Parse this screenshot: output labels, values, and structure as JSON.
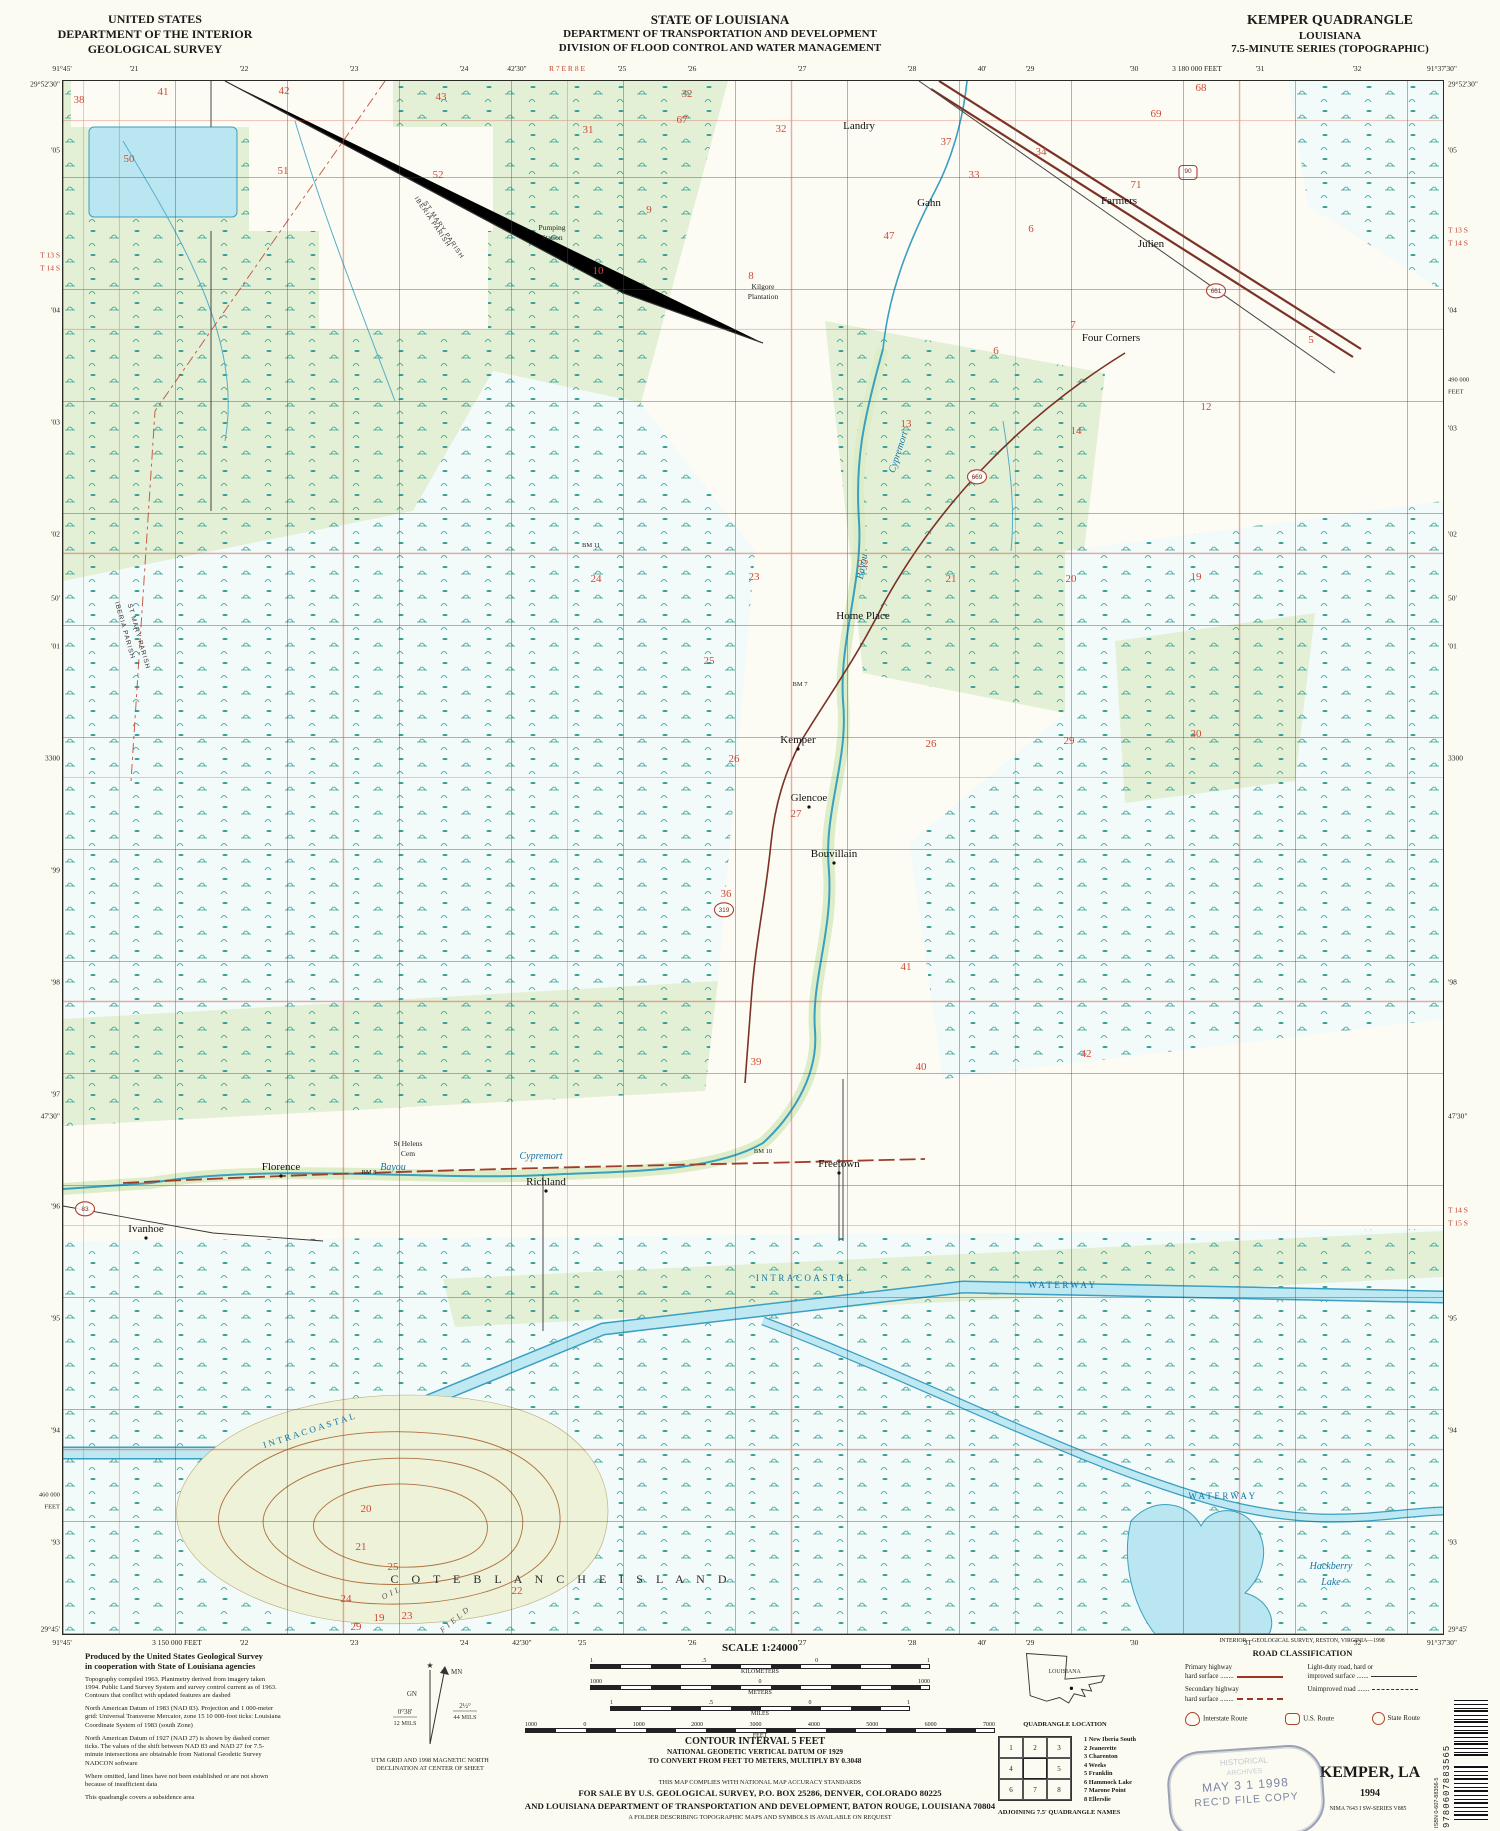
{
  "header": {
    "left": [
      "UNITED STATES",
      "DEPARTMENT OF THE INTERIOR",
      "GEOLOGICAL SURVEY"
    ],
    "center": [
      "STATE OF LOUISIANA",
      "DEPARTMENT OF TRANSPORTATION AND DEVELOPMENT",
      "DIVISION OF FLOOD CONTROL AND WATER MANAGEMENT"
    ],
    "right": [
      "KEMPER QUADRANGLE",
      "LOUISIANA",
      "7.5-MINUTE SERIES (TOPOGRAPHIC)"
    ]
  },
  "map": {
    "colors": {
      "marsh_teal": "#2e9e96",
      "wood_green": "#e3f0d5",
      "marsh_white": "#f3fafa",
      "water_fill": "#b9e6f0",
      "water_line": "#3b9fc1",
      "survey_red": "#c0432f",
      "road_brown": "#7a3226",
      "contour_brown": "#b0713f",
      "section_red": "#cf4a36"
    },
    "labels": [
      {
        "x": 796,
        "y": 48,
        "t": "Landry"
      },
      {
        "x": 489,
        "y": 149,
        "t": "Pumping",
        "c": "sm"
      },
      {
        "x": 489,
        "y": 159,
        "t": "Station",
        "c": "sm"
      },
      {
        "x": 700,
        "y": 208,
        "t": "Kilgore",
        "c": "sm"
      },
      {
        "x": 700,
        "y": 218,
        "t": "Plantation",
        "c": "sm"
      },
      {
        "x": 866,
        "y": 125,
        "t": "Gahn"
      },
      {
        "x": 1056,
        "y": 123,
        "t": "Farmers"
      },
      {
        "x": 1088,
        "y": 166,
        "t": "Julien"
      },
      {
        "x": 1048,
        "y": 260,
        "t": "Four Corners"
      },
      {
        "x": 800,
        "y": 538,
        "t": "Home Place"
      },
      {
        "x": 735,
        "y": 662,
        "t": "Kemper",
        "d": 1
      },
      {
        "x": 746,
        "y": 720,
        "t": "Glencoe",
        "d": 1
      },
      {
        "x": 771,
        "y": 776,
        "t": "Bouvillain",
        "d": 1
      },
      {
        "x": 218,
        "y": 1089,
        "t": "Florence",
        "d": 1
      },
      {
        "x": 483,
        "y": 1104,
        "t": "Richland",
        "d": 1
      },
      {
        "x": 776,
        "y": 1086,
        "t": "Freetown",
        "d": 1
      },
      {
        "x": 83,
        "y": 1151,
        "t": "Ivanhoe",
        "d": 1
      },
      {
        "x": 345,
        "y": 1065,
        "t": "St Helens",
        "c": "sm"
      },
      {
        "x": 345,
        "y": 1075,
        "t": "Cem",
        "c": "sm"
      },
      {
        "x": 498,
        "y": 1502,
        "t": "C O T E   B L A N C H E   I S L A N D",
        "c": "isl"
      },
      {
        "x": 330,
        "y": 1514,
        "t": "OIL",
        "c": "fld",
        "r": -25
      },
      {
        "x": 394,
        "y": 1540,
        "t": "FIELD",
        "c": "fld",
        "r": -40
      },
      {
        "x": 1268,
        "y": 1488,
        "t": "Hackberry",
        "c": "wat"
      },
      {
        "x": 1268,
        "y": 1504,
        "t": "Lake",
        "c": "wat"
      },
      {
        "x": 330,
        "y": 1089,
        "t": "Bayou",
        "c": "wat"
      },
      {
        "x": 478,
        "y": 1078,
        "t": "Cypremort",
        "c": "wat"
      },
      {
        "x": 838,
        "y": 372,
        "t": "Cypremort",
        "c": "wat",
        "r": -72
      },
      {
        "x": 802,
        "y": 486,
        "t": "Bayou",
        "c": "wat",
        "r": -80
      },
      {
        "x": 248,
        "y": 1352,
        "t": "INTRACOASTAL",
        "c": "wt2",
        "r": -18
      },
      {
        "x": 742,
        "y": 1200,
        "t": "INTRACOASTAL",
        "c": "wt2"
      },
      {
        "x": 1000,
        "y": 1207,
        "t": "WATERWAY",
        "c": "wt2"
      },
      {
        "x": 1160,
        "y": 1418,
        "t": "WATERWAY",
        "c": "wt2"
      },
      {
        "x": 368,
        "y": 142,
        "t": "IBERIA PARISH",
        "c": "par",
        "r": 56
      },
      {
        "x": 379,
        "y": 150,
        "t": "ST MARY PARISH",
        "c": "par",
        "r": 56
      },
      {
        "x": 60,
        "y": 550,
        "t": "IBERIA PARISH",
        "c": "par",
        "r": 74
      },
      {
        "x": 74,
        "y": 556,
        "t": "ST MARY PARISH",
        "c": "par",
        "r": 74
      },
      {
        "x": 306,
        "y": 1093,
        "t": "BM 8",
        "c": "bm"
      },
      {
        "x": 528,
        "y": 466,
        "t": "BM 11",
        "c": "bm"
      },
      {
        "x": 737,
        "y": 605,
        "t": "BM 7",
        "c": "bm"
      },
      {
        "x": 700,
        "y": 1072,
        "t": "BM 10",
        "c": "bm"
      }
    ],
    "sections": [
      [
        16,
        22,
        "38"
      ],
      [
        100,
        14,
        "41"
      ],
      [
        221,
        13,
        "42"
      ],
      [
        378,
        19,
        "43"
      ],
      [
        525,
        52,
        "31"
      ],
      [
        624,
        16,
        "32"
      ],
      [
        619,
        42,
        "67"
      ],
      [
        718,
        51,
        "32"
      ],
      [
        883,
        64,
        "37"
      ],
      [
        911,
        97,
        "33"
      ],
      [
        978,
        74,
        "34"
      ],
      [
        1093,
        36,
        "69"
      ],
      [
        1138,
        10,
        "68"
      ],
      [
        1073,
        107,
        "71"
      ],
      [
        66,
        81,
        "50"
      ],
      [
        220,
        93,
        "51"
      ],
      [
        375,
        97,
        "52"
      ],
      [
        586,
        132,
        "9"
      ],
      [
        826,
        158,
        "47"
      ],
      [
        968,
        151,
        "6"
      ],
      [
        535,
        193,
        "10"
      ],
      [
        688,
        198,
        "8"
      ],
      [
        933,
        273,
        "6"
      ],
      [
        1013,
        353,
        "14"
      ],
      [
        843,
        346,
        "13"
      ],
      [
        1143,
        329,
        "12"
      ],
      [
        533,
        501,
        "24"
      ],
      [
        691,
        499,
        "23"
      ],
      [
        800,
        486,
        "22"
      ],
      [
        888,
        501,
        "21"
      ],
      [
        1008,
        501,
        "20"
      ],
      [
        1133,
        499,
        "19"
      ],
      [
        646,
        583,
        "25"
      ],
      [
        671,
        681,
        "26"
      ],
      [
        868,
        666,
        "26"
      ],
      [
        1006,
        663,
        "29"
      ],
      [
        1133,
        656,
        "30"
      ],
      [
        733,
        736,
        "27"
      ],
      [
        663,
        816,
        "36"
      ],
      [
        843,
        889,
        "41"
      ],
      [
        1023,
        976,
        "42"
      ],
      [
        693,
        984,
        "39"
      ],
      [
        858,
        989,
        "40"
      ],
      [
        1010,
        247,
        "7"
      ],
      [
        1248,
        262,
        "5"
      ],
      [
        303,
        1431,
        "20"
      ],
      [
        298,
        1469,
        "21"
      ],
      [
        330,
        1489,
        "25"
      ],
      [
        283,
        1521,
        "24"
      ],
      [
        316,
        1540,
        "19"
      ],
      [
        344,
        1538,
        "23"
      ],
      [
        454,
        1513,
        "22"
      ],
      [
        293,
        1549,
        "29"
      ]
    ],
    "shields": [
      {
        "x": 1125,
        "y": 92,
        "n": "90",
        "k": "us"
      },
      {
        "x": 1153,
        "y": 212,
        "n": "661",
        "k": "st"
      },
      {
        "x": 914,
        "y": 398,
        "n": "669",
        "k": "st"
      },
      {
        "x": 22,
        "y": 1130,
        "n": "83",
        "k": "st"
      },
      {
        "x": 661,
        "y": 831,
        "n": "319",
        "k": "st"
      }
    ],
    "ticks": {
      "top": [
        {
          "x": 0,
          "t": "91°45'"
        },
        {
          "x": 72,
          "t": "'21"
        },
        {
          "x": 182,
          "t": "'22"
        },
        {
          "x": 292,
          "t": "'23"
        },
        {
          "x": 402,
          "t": "'24"
        },
        {
          "x": 455,
          "t": "42'30\""
        },
        {
          "x": 505,
          "t": "R 7 E  R 8 E",
          "c": "red"
        },
        {
          "x": 560,
          "t": "'25"
        },
        {
          "x": 630,
          "t": "'26"
        },
        {
          "x": 740,
          "t": "'27"
        },
        {
          "x": 850,
          "t": "'28"
        },
        {
          "x": 920,
          "t": "40'"
        },
        {
          "x": 968,
          "t": "'29"
        },
        {
          "x": 1072,
          "t": "'30"
        },
        {
          "x": 1135,
          "t": "3 180 000 FEET"
        },
        {
          "x": 1198,
          "t": "'31"
        },
        {
          "x": 1295,
          "t": "'32"
        },
        {
          "x": 1380,
          "t": "91°37'30\""
        }
      ],
      "bottom": [
        {
          "x": 0,
          "t": "91°45'"
        },
        {
          "x": 115,
          "t": "3 150 000 FEET"
        },
        {
          "x": 182,
          "t": "'22"
        },
        {
          "x": 292,
          "t": "'23"
        },
        {
          "x": 402,
          "t": "'24"
        },
        {
          "x": 460,
          "t": "42'30\""
        },
        {
          "x": 520,
          "t": "'25"
        },
        {
          "x": 630,
          "t": "'26"
        },
        {
          "x": 740,
          "t": "'27"
        },
        {
          "x": 850,
          "t": "'28"
        },
        {
          "x": 920,
          "t": "40'"
        },
        {
          "x": 968,
          "t": "'29"
        },
        {
          "x": 1072,
          "t": "'30"
        },
        {
          "x": 1185,
          "t": "'31"
        },
        {
          "x": 1295,
          "t": "'32"
        },
        {
          "x": 1380,
          "t": "91°37'30\""
        }
      ],
      "left": [
        {
          "y": 4,
          "t": "29°52'30\""
        },
        {
          "y": 70,
          "t": "'05"
        },
        {
          "y": 175,
          "t": "T 13 S",
          "c": "red"
        },
        {
          "y": 188,
          "t": "T 14 S",
          "c": "red"
        },
        {
          "y": 230,
          "t": "'04"
        },
        {
          "y": 342,
          "t": "'03"
        },
        {
          "y": 454,
          "t": "'02"
        },
        {
          "y": 518,
          "t": "50'"
        },
        {
          "y": 566,
          "t": "'01"
        },
        {
          "y": 678,
          "t": "3300"
        },
        {
          "y": 790,
          "t": "'99"
        },
        {
          "y": 902,
          "t": "'98"
        },
        {
          "y": 1014,
          "t": "'97"
        },
        {
          "y": 1036,
          "t": "47'30\""
        },
        {
          "y": 1126,
          "t": "'96"
        },
        {
          "y": 1238,
          "t": "'95"
        },
        {
          "y": 1350,
          "t": "'94"
        },
        {
          "y": 1415,
          "t": "460 000",
          "c": "ft"
        },
        {
          "y": 1427,
          "t": "FEET",
          "c": "ft"
        },
        {
          "y": 1462,
          "t": "'93"
        },
        {
          "y": 1549,
          "t": "29°45'"
        }
      ],
      "right": [
        {
          "y": 4,
          "t": "29°52'30\""
        },
        {
          "y": 70,
          "t": "'05"
        },
        {
          "y": 150,
          "t": "T 13 S",
          "c": "red"
        },
        {
          "y": 163,
          "t": "T 14 S",
          "c": "red"
        },
        {
          "y": 230,
          "t": "'04"
        },
        {
          "y": 300,
          "t": "490 000",
          "c": "ft"
        },
        {
          "y": 312,
          "t": "FEET",
          "c": "ft"
        },
        {
          "y": 348,
          "t": "'03"
        },
        {
          "y": 454,
          "t": "'02"
        },
        {
          "y": 518,
          "t": "50'"
        },
        {
          "y": 566,
          "t": "'01"
        },
        {
          "y": 678,
          "t": "3300"
        },
        {
          "y": 902,
          "t": "'98"
        },
        {
          "y": 1036,
          "t": "47'30\""
        },
        {
          "y": 1130,
          "t": "T 14 S",
          "c": "red"
        },
        {
          "y": 1143,
          "t": "T 15 S",
          "c": "red"
        },
        {
          "y": 1238,
          "t": "'95"
        },
        {
          "y": 1350,
          "t": "'94"
        },
        {
          "y": 1462,
          "t": "'93"
        },
        {
          "y": 1549,
          "t": "29°45'"
        }
      ]
    }
  },
  "footer": {
    "credit": "INTERIOR—GEOLOGICAL SURVEY, RESTON, VIRGINIA—1998",
    "produced": [
      "Produced by the United States Geological Survey",
      "in cooperation with State of Louisiana agencies"
    ],
    "notes": [
      "Topography compiled 1963.  Planimetry derived from imagery taken 1994.  Public Land Survey System and survey control current as of 1963.  Contours that conflict with updated features are dashed",
      "North American Datum of 1983 (NAD 83).  Projection and 1 000-meter grid: Universal Transverse Mercator, zone 15 10 000-foot ticks: Louisiana Coordinate System of 1983 (south Zone)",
      "North American Datum of 1927 (NAD 27) is shown by dashed corner ticks.  The values of the shift between NAD 83 and NAD 27 for 7.5-minute intersections are obtainable from National Geodetic Survey NADCON software",
      "Where omitted, land lines have not been established or are not shown because of insufficient data",
      "This quadrangle covers a subsidence area"
    ],
    "declination": {
      "mn": "MN",
      "gn": "GN",
      "gn_deg": "0°38'",
      "gn_mils": "12 MILS",
      "mn_deg": "2½°",
      "mn_mils": "44 MILS",
      "cap1": "UTM GRID AND 1998 MAGNETIC NORTH",
      "cap2": "DECLINATION AT CENTER OF SHEET"
    },
    "scale": {
      "title": "SCALE 1:24000",
      "bars": [
        {
          "labels": [
            "1",
            ".5",
            "0",
            "1"
          ],
          "caption": "KILOMETERS",
          "w": 340
        },
        {
          "labels": [
            "1000",
            "0",
            "1000"
          ],
          "caption": "METERS",
          "w": 340
        },
        {
          "labels": [
            "1",
            ".5",
            "0",
            "1"
          ],
          "caption": "MILES",
          "w": 300
        },
        {
          "labels": [
            "1000",
            "0",
            "1000",
            "2000",
            "3000",
            "4000",
            "5000",
            "6000",
            "7000"
          ],
          "caption": "FEET",
          "w": 470
        }
      ]
    },
    "contour": [
      "CONTOUR INTERVAL 5 FEET",
      "NATIONAL GEODETIC VERTICAL DATUM OF 1929",
      "TO CONVERT FROM FEET TO METERS, MULTIPLY BY 0.3048"
    ],
    "accuracy": [
      "THIS MAP COMPLIES WITH NATIONAL MAP ACCURACY STANDARDS",
      "FOR SALE BY U.S. GEOLOGICAL SURVEY, P.O. BOX 25286, DENVER, COLORADO 80225",
      "AND LOUISIANA DEPARTMENT OF TRANSPORTATION AND DEVELOPMENT, BATON ROUGE, LOUISIANA 70804",
      "A FOLDER DESCRIBING TOPOGRAPHIC MAPS AND SYMBOLS IS AVAILABLE ON REQUEST"
    ],
    "quad_location": {
      "label": "LOUISIANA",
      "caption": "QUADRANGLE LOCATION"
    },
    "adjoining": {
      "cells": [
        "1",
        "2",
        "3",
        "4",
        "",
        "5",
        "6",
        "7",
        "8"
      ],
      "names": [
        "New Iberia South",
        "Jeanerette",
        "Charenton",
        "Weeks",
        "Franklin",
        "Hammock Lake",
        "Marone Point",
        "Ellerslie"
      ],
      "caption": "ADJOINING 7.5' QUADRANGLE NAMES"
    },
    "road_class": {
      "title": "ROAD CLASSIFICATION",
      "rows": [
        {
          "l1": "Primary highway",
          "l2": "hard surface ........",
          "k": "primary"
        },
        {
          "l1": "Light-duty road, hard or",
          "l2": "improved surface .......",
          "k": "light"
        },
        {
          "l1": "Secondary highway",
          "l2": "hard surface ........",
          "k": "secondary"
        },
        {
          "l1": "",
          "l2": "Unimproved road .......",
          "k": "unimproved"
        }
      ],
      "shields": [
        {
          "k": "int",
          "t": "Interstate Route"
        },
        {
          "k": "us",
          "t": "U.S. Route"
        },
        {
          "k": "st",
          "t": "State Route"
        }
      ]
    },
    "title_block": {
      "title": "KEMPER, LA",
      "year": "1994",
      "series": "NIMA 7643 I SW-SERIES V885"
    },
    "barcode": {
      "isbn": "ISBN 0-607-88356-5",
      "ean": "9780607883565"
    },
    "stamp": {
      "l1": "HISTORICAL",
      "l2": "ARCHIVES",
      "l3": "MAY 3 1 1998",
      "l4": "REC'D FILE COPY"
    }
  }
}
